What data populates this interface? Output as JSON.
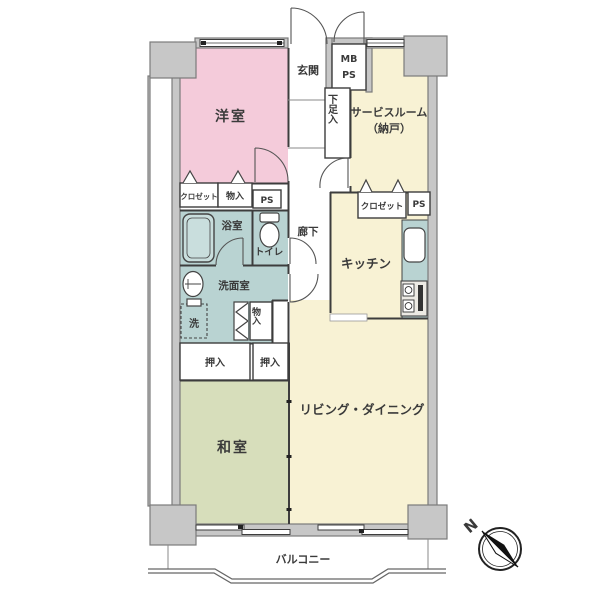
{
  "plan": {
    "colors": {
      "bedroom": "#f4cbda",
      "cream": "#f8f2d4",
      "tatami": "#d7debb",
      "wet": "#b9d3d2",
      "counter": "#b9d3d2"
    },
    "rooms": {
      "western": "洋室",
      "entrance": "玄関",
      "service1": "サービスルーム",
      "service2": "（納戸）",
      "bathroom": "浴室",
      "toilet": "トイレ",
      "hallway": "廊下",
      "washroom": "洗面室",
      "kitchen": "キッチン",
      "tatami": "和室",
      "living": "リビング・ダイニング",
      "balcony": "バルコニー"
    },
    "storage": {
      "closet_bedroom": "クロゼット",
      "monoire_bedroom": "物入",
      "ps_hall": "PS",
      "shoe_cabinet": "下足入",
      "mb": "MB",
      "mb_ps": "PS",
      "closet_service": "クロゼット",
      "ps_service": "PS",
      "laundry": "洗",
      "monoire_hall": "物入",
      "oshiire_left": "押入",
      "oshiire_right": "押入"
    },
    "compass": {
      "north": "N"
    }
  }
}
